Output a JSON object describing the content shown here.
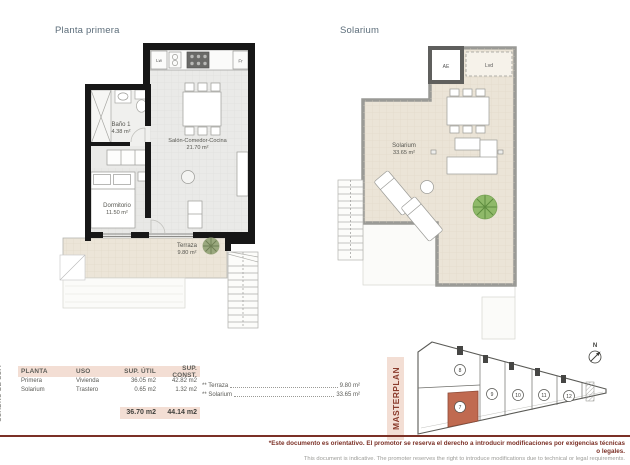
{
  "sheet": {
    "plan_left": {
      "title": "Planta primera",
      "rooms": {
        "bano": {
          "name": "Baño 1",
          "area": "4.38 m²"
        },
        "salon": {
          "name": "Salón-Comedor-Cocina",
          "area": "21.70 m²"
        },
        "dormitorio": {
          "name": "Dormitorio",
          "area": "11.50 m²"
        },
        "terraza": {
          "name": "Terraza",
          "area": "9.80 m²"
        }
      },
      "appliances": {
        "lw": "Lw",
        "fr": "Fr"
      }
    },
    "plan_right": {
      "title": "Solarium",
      "rooms": {
        "solarium": {
          "name": "Solarium",
          "area": "33.65 m²"
        }
      },
      "labels": {
        "ae": "AE",
        "lvd": "Lvd"
      }
    },
    "table": {
      "side_label": "CUADRO DE SUP.",
      "headers": {
        "planta": "PLANTA",
        "uso": "USO",
        "util": "SUP. ÚTIL",
        "const": "SUP. CONST."
      },
      "rows": [
        {
          "planta": "Primera",
          "uso": "Vivienda",
          "util": "36.05 m2",
          "const": "42.82 m2"
        },
        {
          "planta": "Solarium",
          "uso": "Trastero",
          "util": "0.65 m2",
          "const": "1.32 m2"
        }
      ],
      "total_util": "36.70 m2",
      "total_const": "44.14 m2",
      "extras": [
        {
          "label": "** Terraza",
          "value": "9.80 m²"
        },
        {
          "label": "** Solarium",
          "value": "33.65 m²"
        }
      ]
    },
    "masterplan": {
      "title": "MASTERPLAN",
      "north": "N",
      "unit_highlight": "7",
      "units": [
        "8",
        "9",
        "10",
        "11",
        "12"
      ]
    },
    "footer": {
      "line_es": "*Este documento es orientativo. El promotor se reserva el derecho a introducir modificaciones por exigencias técnicas o legales.",
      "line_en": "This document is indicative. The promoter reserves the right to introduce modifications due to technical or legal requirements."
    },
    "colors": {
      "accent": "#7b3026",
      "header_bg": "#f3ded4",
      "highlight_unit": "#c06a50",
      "title_text": "#5c6d7a"
    }
  }
}
